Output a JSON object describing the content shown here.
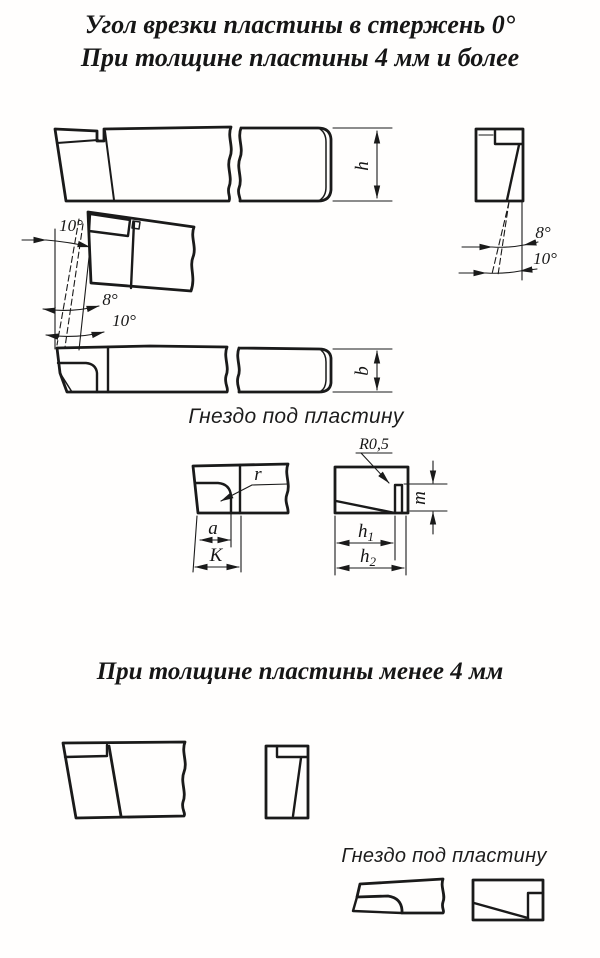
{
  "header": {
    "title_line1": "Угол врезки пластины в стержень 0°",
    "title_line2": "При толщине пластины 4 мм и более"
  },
  "section_small": {
    "title": "При толщине пластины менее 4 мм"
  },
  "captions": {
    "socket_top": "Гнездо под пластину",
    "socket_bottom": "Гнездо под пластину"
  },
  "dims": {
    "h": "h",
    "b": "b",
    "r": "r",
    "a": "a",
    "K": "K",
    "m": "m",
    "R05": "R0,5",
    "h1_base": "h",
    "h1_sub": "1",
    "h2_base": "h",
    "h2_sub": "2",
    "plan_top_angle": "10°",
    "plan_8": "8°",
    "plan_10": "10°",
    "end_8": "8°",
    "end_10": "10°"
  },
  "colors": {
    "ink": "#1a1a1a",
    "paper": "#fffefd"
  }
}
